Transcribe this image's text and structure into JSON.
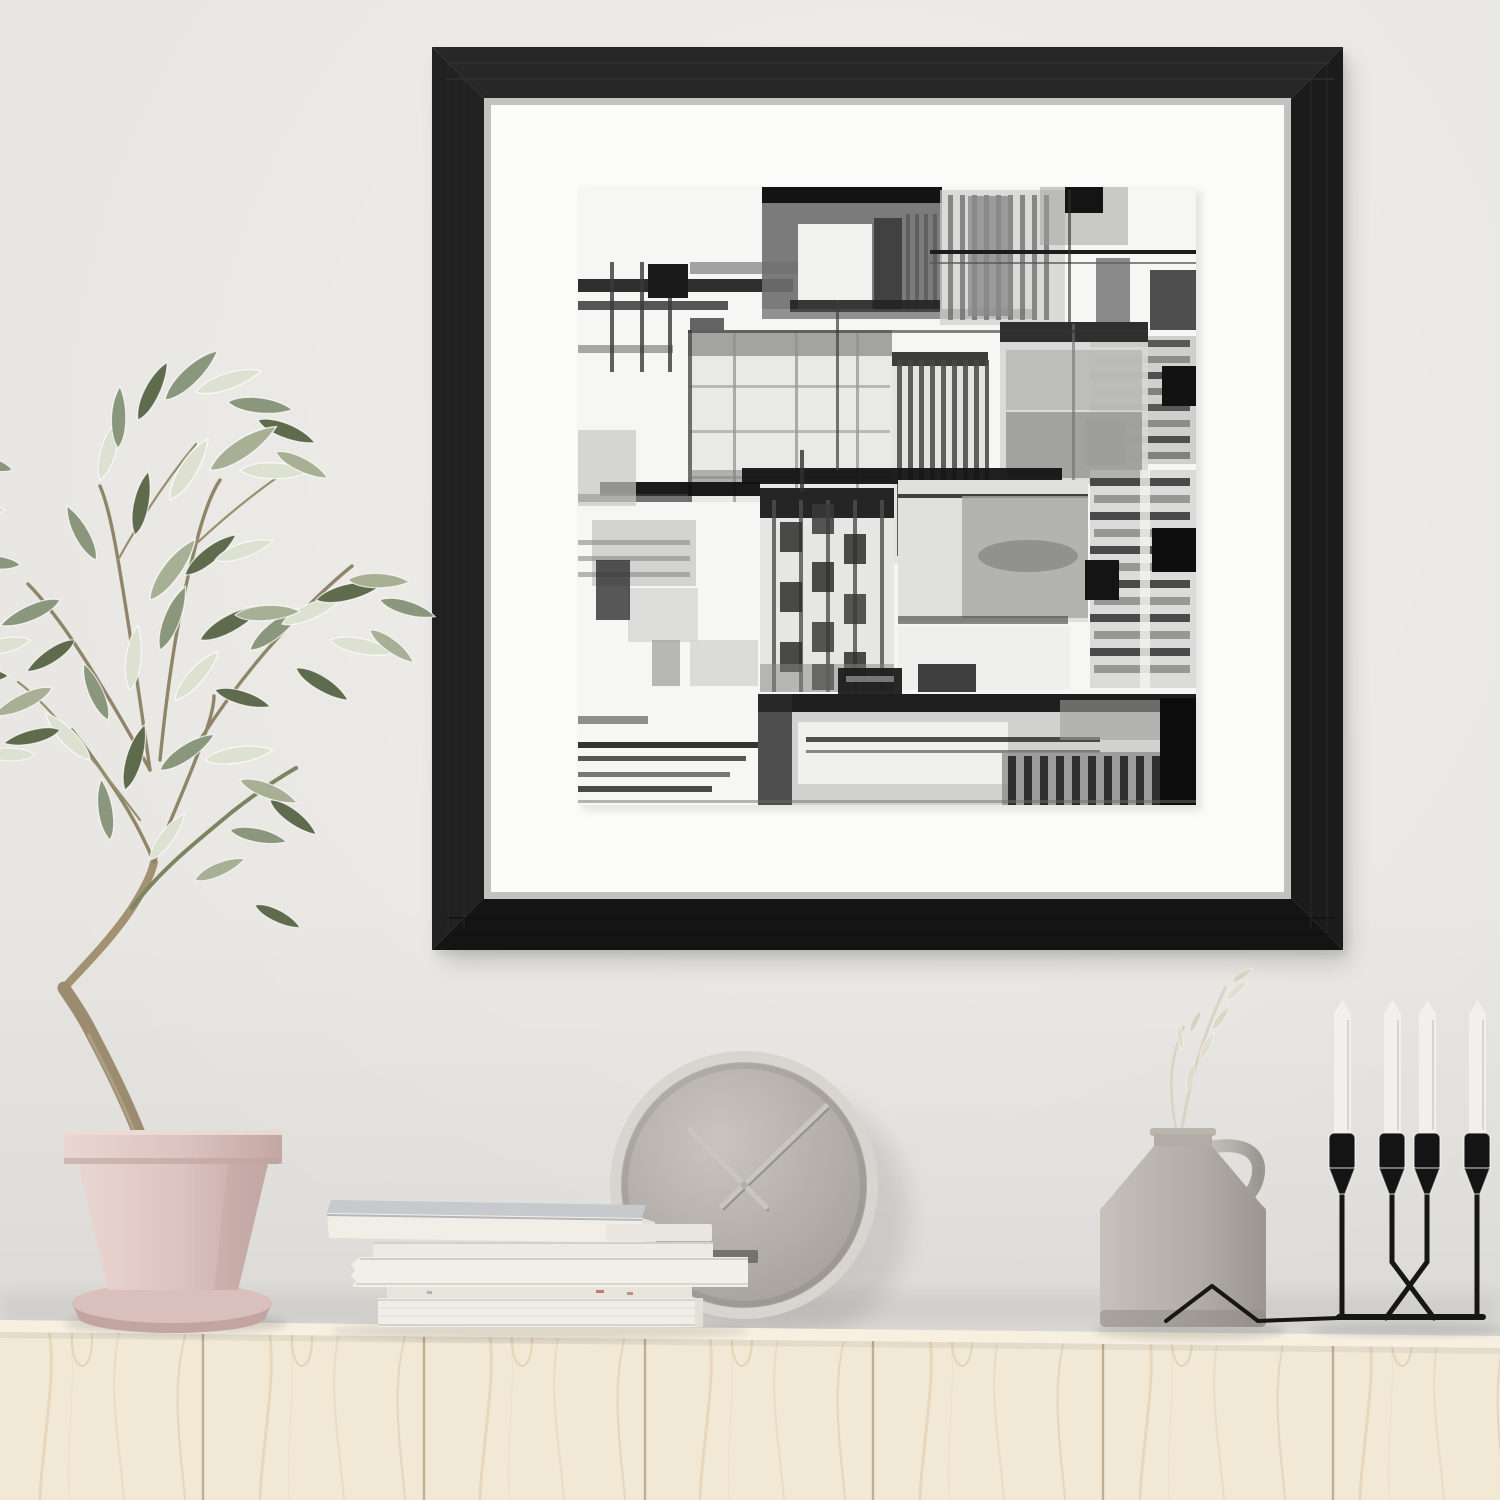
{
  "scene": {
    "title": "Black framed abstract ink art print in a styled interior",
    "description": "A square black wood frame with a wide white mat displays an abstract black-and-white ink painting, hanging on a pale gray wall above a light birch sideboard styled with an olive tree in a pink pot, a stack of white books, a round gray wall clock, a gray ceramic jug vase with a dried sprig, and a black candelabra holding four white taper candles.",
    "objects": [
      {
        "name": "picture-frame",
        "description": "square black wood frame with wide white mat"
      },
      {
        "name": "abstract-artwork",
        "description": "black, gray and white abstract ink composition of stacked rectangles, grids and stripes"
      },
      {
        "name": "olive-plant",
        "description": "potted olive tree with sage green and pale leaves"
      },
      {
        "name": "plant-pot",
        "description": "pale pink tapered pot on matching saucer"
      },
      {
        "name": "wall-clock",
        "description": "round gray minimalist clock with thin metal hands and no numerals"
      },
      {
        "name": "book-stack",
        "description": "six stacked white and cream books and magazines"
      },
      {
        "name": "vase",
        "description": "warm gray ceramic jug vase with loop handle and dried pale sprig"
      },
      {
        "name": "candelabra",
        "description": "black wire candelabra with four white taper candles"
      },
      {
        "name": "sideboard",
        "description": "pale birch wood sideboard with vertical panel seams"
      }
    ],
    "counts": {
      "candles": 4,
      "books_in_stack": 6,
      "sideboard_panels_visible": 7
    },
    "clock_hands": {
      "long_hand_direction": "upper-right",
      "short_hand_direction": "upper-left"
    }
  },
  "palette": {
    "wall": "#e8e6e2",
    "frame": "#1e1e1e",
    "mat": "#fbfbfa",
    "paper": "#f6f6f4",
    "ink": "#161616",
    "wood": "#f1e8d6",
    "wood_grain": "#e3d3b6",
    "wood_seam": "#b3a183",
    "pot": "#ddc6c2",
    "pot_deep": "#c3a7a3",
    "saucer": "#d9c0bc",
    "trunk": "#9c8c6f",
    "trunk_light": "#8f8568",
    "leaf": "#8b977c",
    "leaf_dark": "#5e6b4c",
    "leaf_pale": "#dde1d2",
    "leaf_sage": "#a7af94",
    "clock_face": "#b6b1ac",
    "clock_rim": "#d8d5d1",
    "clock_hand": "#c9c5c0",
    "book_white": "#f1eee8",
    "book_cream": "#e8e4dc",
    "book_top": "#c6cacc",
    "book_dark_sliver": "#75726d",
    "vase": "#b4afa9",
    "vase_deep": "#9a958f",
    "candle": "#f2f0ec",
    "holder": "#141414",
    "speck": "#b06a5e"
  }
}
